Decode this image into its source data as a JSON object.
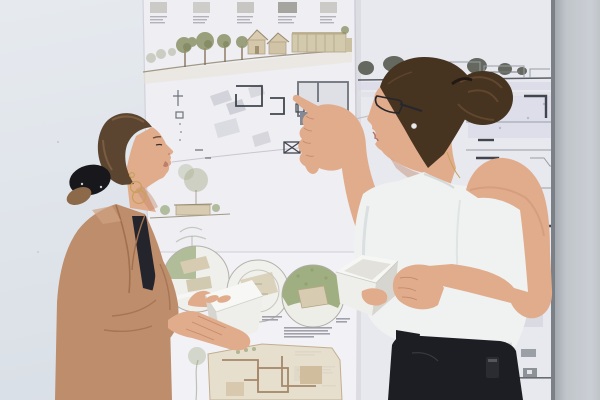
{
  "scene": {
    "setting": "two-designers-reviewing-architecture-boards",
    "objects": [
      "wall",
      "presentation-board-center",
      "presentation-board-right",
      "wall-panel-right",
      "designer-left",
      "designer-right",
      "architectural-model-left",
      "architectural-model-right"
    ]
  },
  "colors": {
    "wall_left": "#e8ebf1",
    "wall_left_deep": "#dde2e9",
    "wall_right": "#c7cbd1",
    "wall_right_deep": "#a7abb2",
    "wall_edge": "#7d8187",
    "paper_main": "#f2f1f6",
    "paper_bright": "#f6f5f9",
    "paper_right": "#ecebf2",
    "paper_edge": "#d9d8e0",
    "plan_line": "#70747d",
    "plan_line_dark": "#42454d",
    "plan_line_soft": "#9aa0a8",
    "plan_fill": "#d7d6de",
    "plan_fill_lav": "#dcdcea",
    "elev_tan": "#d8c9ac",
    "elev_tan_line": "#a99877",
    "tree_olive": "#8f9569",
    "tree_olive_dark": "#747a52",
    "site_green": "#a3b183",
    "site_tan": "#dbcfb4",
    "trunk": "#7d5f45",
    "ink_dark": "#66695f",
    "text_gray": "#a3a1ac",
    "skin": "#e5ae8d",
    "skin_shade": "#c88c6d",
    "skin_deep": "#b0755a",
    "hair_l": "#5d452f",
    "hair_l_hi": "#8d6a49",
    "hair_r": "#47321f",
    "hair_r_hi": "#6d4e35",
    "scrunchie": "#18171b",
    "blazer": "#c18e6d",
    "blazer_sh": "#a4714f",
    "blazer_hi": "#d3a585",
    "top_dark": "#24232b",
    "top_white": "#f3f5f4",
    "top_white_sh": "#d8dddd",
    "pants": "#1c1d22",
    "badge": "#2a2b31",
    "model": "#f2f1ee",
    "model_side": "#dbd8d2",
    "model_inner": "#e7e4df",
    "gold": "#c9a35a",
    "pearl": "#eeecee",
    "glasses": "#27262c"
  }
}
